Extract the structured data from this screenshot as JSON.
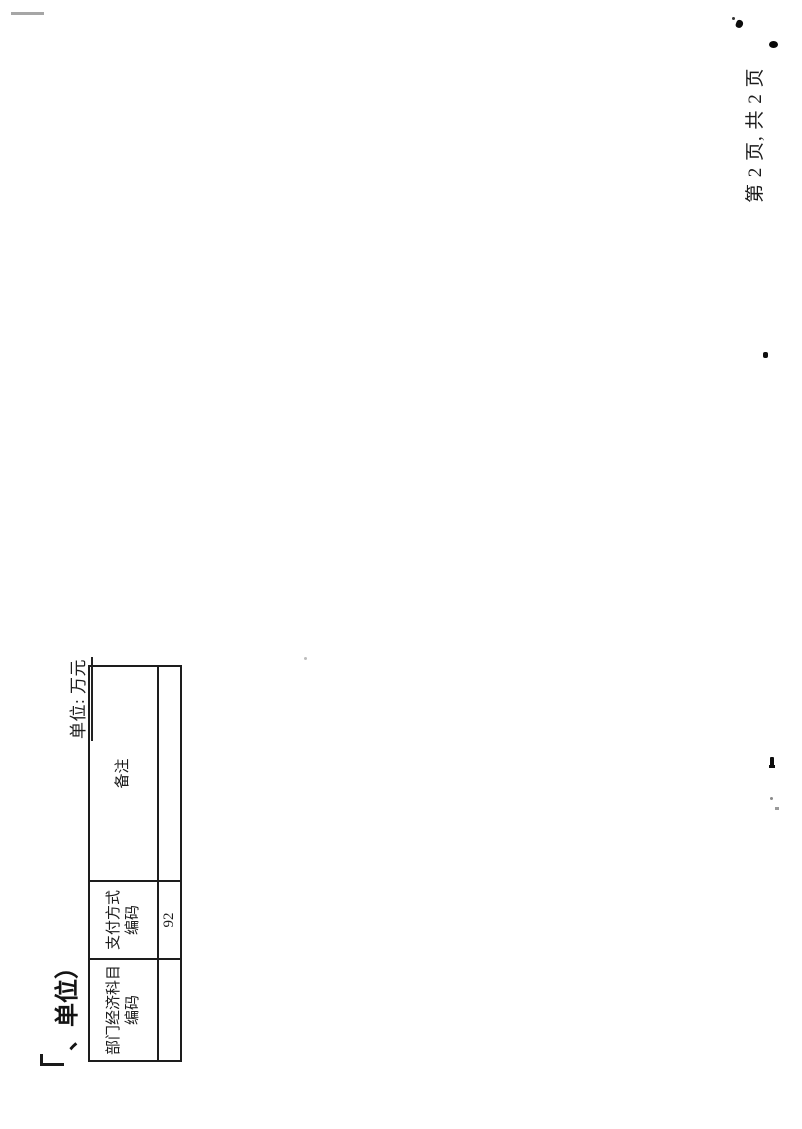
{
  "document": {
    "title_fragment": "、单位）",
    "unit_label": "单位: 万元",
    "page_number": "第 2 页, 共 2 页"
  },
  "table": {
    "headers": [
      {
        "line1": "部门经济科目",
        "line2": "编码"
      },
      {
        "line1": "支付方式",
        "line2": "编码"
      },
      {
        "line1": "备注",
        "line2": ""
      }
    ],
    "row": [
      "",
      "92",
      ""
    ]
  },
  "colors": {
    "ink": "#1d1d1d",
    "scan_gray": "#a6a6a6",
    "background": "#ffffff"
  }
}
